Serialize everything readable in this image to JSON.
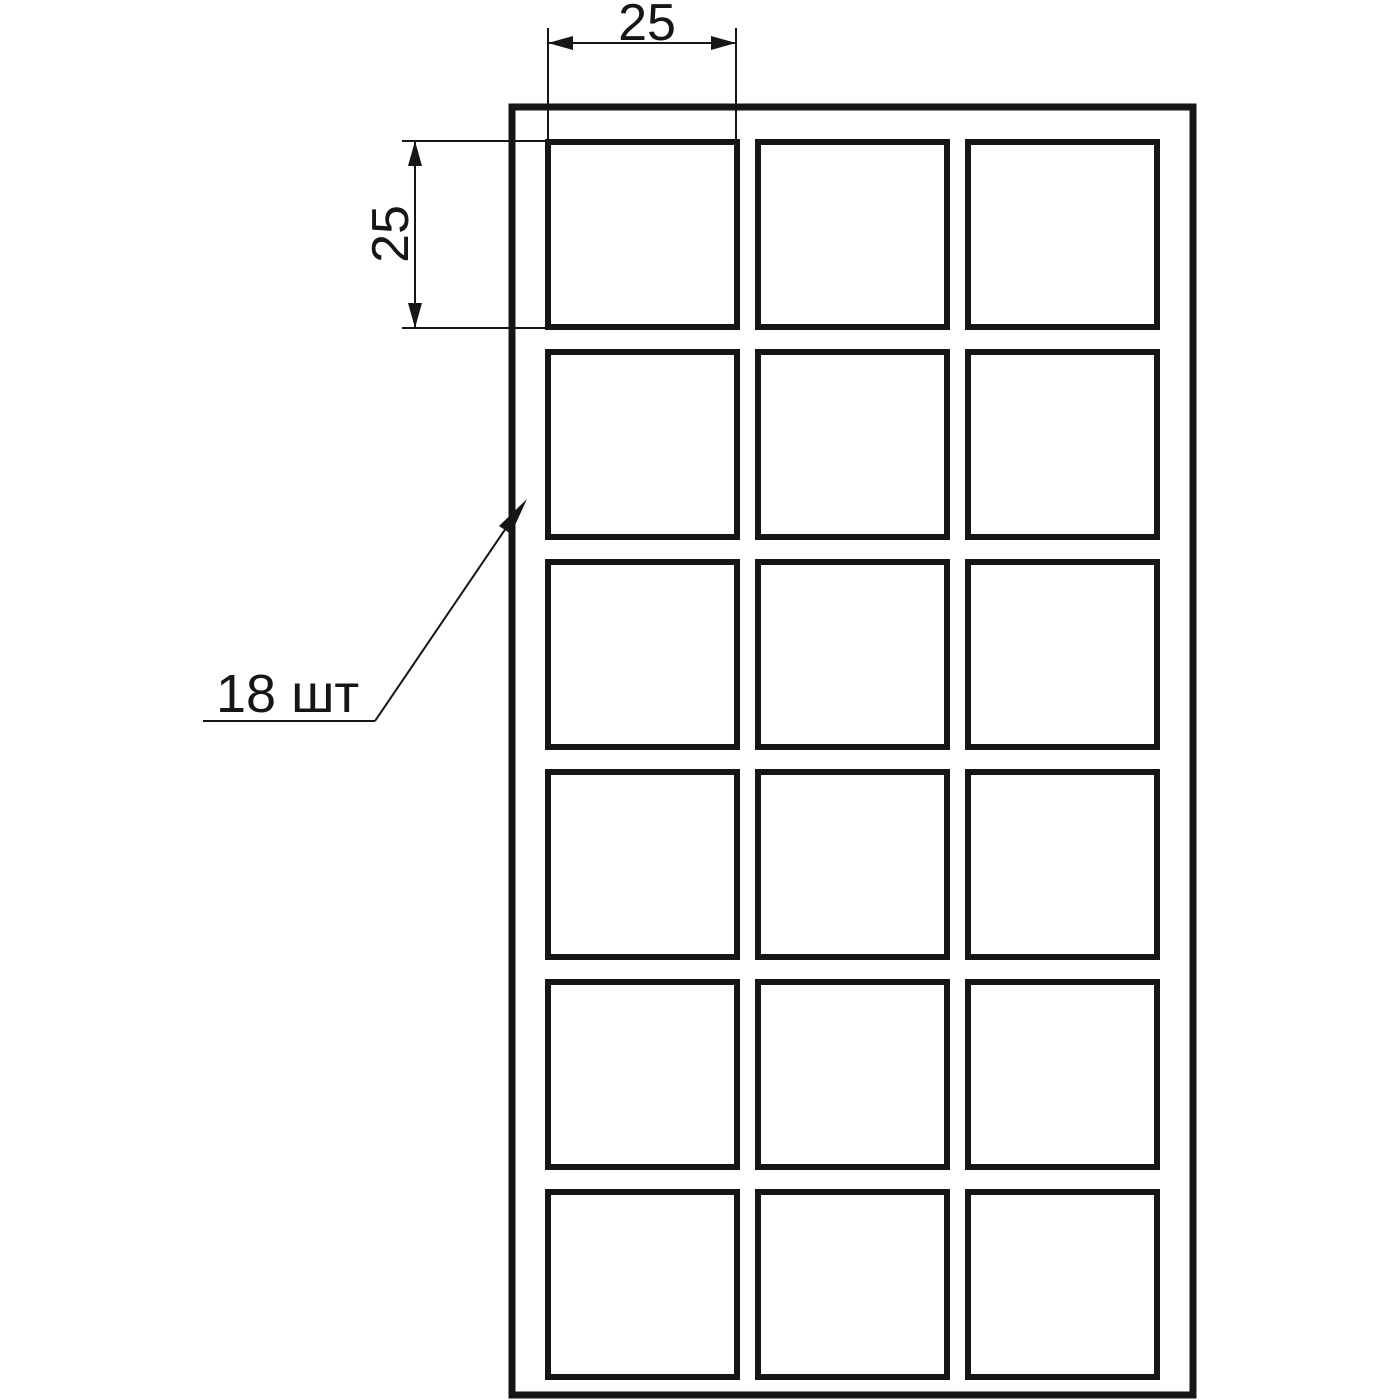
{
  "drawing": {
    "kind": "technical-drawing",
    "background": "#ffffff",
    "line_color": "#161616",
    "sheet": {
      "x": 512,
      "y": 107,
      "width": 681,
      "height": 1288
    },
    "grid": {
      "rows": 6,
      "cols": 3,
      "origin_x": 548,
      "origin_y": 142,
      "pitch_x": 210,
      "pitch_y": 210,
      "cell_width": 189,
      "cell_height": 185,
      "cell_count": 18
    },
    "dimensions": {
      "width": {
        "value": "25"
      },
      "height": {
        "value": "25"
      }
    },
    "callout": {
      "label": "18 шт"
    }
  }
}
